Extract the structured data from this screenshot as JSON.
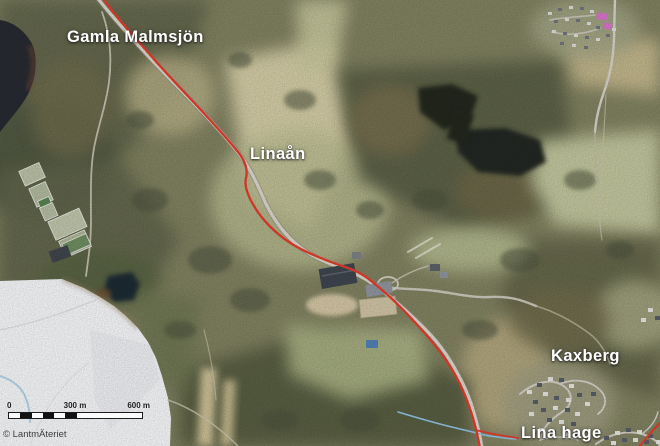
{
  "map": {
    "place_labels": {
      "lake": "Gamla Malmsjön",
      "river": "Linaån",
      "district_north": "Kaxberg",
      "district_south": "Lina hage"
    },
    "scale_bar": {
      "zero_label": "0",
      "mid_label": "300 m",
      "end_label": "600 m"
    },
    "attribution": "© LantmÄteriet",
    "colors": {
      "route_red": "#e13a2a",
      "stream_blue": "#8fc0e2",
      "road_gray": "#d6d3ca",
      "water_dark": "#23261d",
      "lake_dark": "#262a30",
      "masked_area_white": "#f2f3f5",
      "label_white": "#ffffff",
      "marker_pink": "#e06ad8"
    }
  }
}
